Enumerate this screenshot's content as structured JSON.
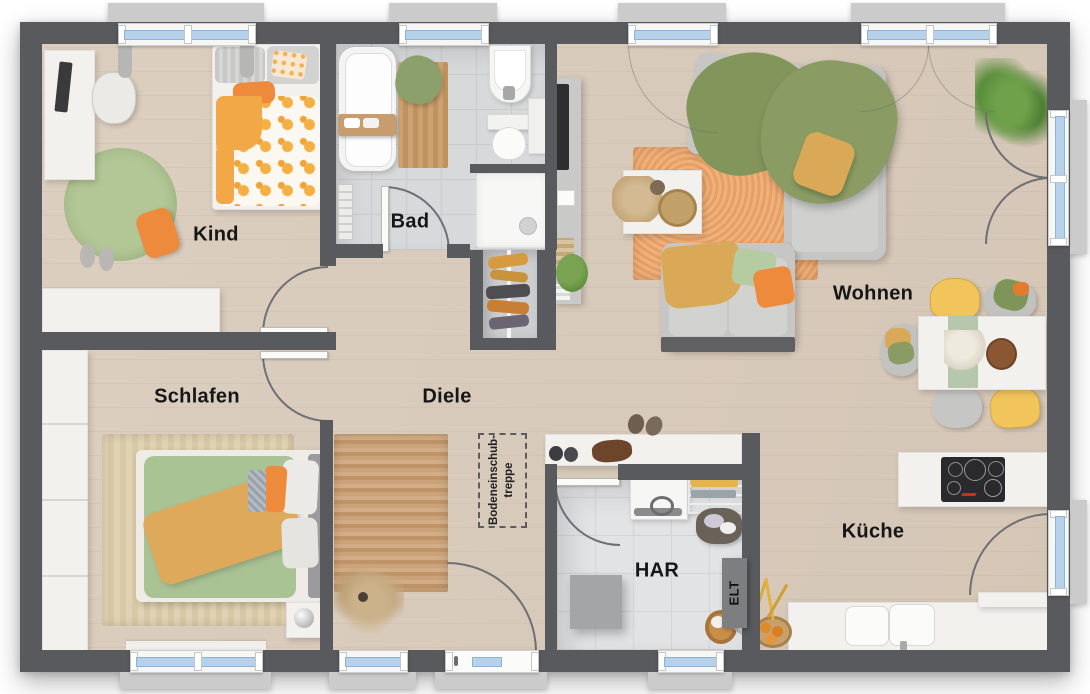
{
  "floorplan": {
    "rooms": {
      "kind": {
        "label": "Kind"
      },
      "bad": {
        "label": "Bad"
      },
      "wohnen": {
        "label": "Wohnen"
      },
      "schlafen": {
        "label": "Schlafen"
      },
      "diele": {
        "label": "Diele"
      },
      "har": {
        "label": "HAR"
      },
      "kueche": {
        "label": "Küche"
      }
    },
    "annotations": {
      "loft_hatch": {
        "line1": "Bodeneinschub-",
        "line2": "treppe"
      },
      "electrical_panel": {
        "label": "ELT"
      }
    },
    "colors": {
      "wall": "#595a5d",
      "wood_floor": "#d7c9ba",
      "bath_tile": "#d8d9db",
      "utility_tile": "#e2e3e5",
      "window_glass": "#b5d2ea",
      "accent_orange": "#ee8a3b",
      "accent_mustard": "#d9a958",
      "accent_green": "#85975e",
      "rug_orange": "#ecaa74",
      "rug_green": "#a9bf8c",
      "rug_jute": "#c59a6f"
    }
  }
}
